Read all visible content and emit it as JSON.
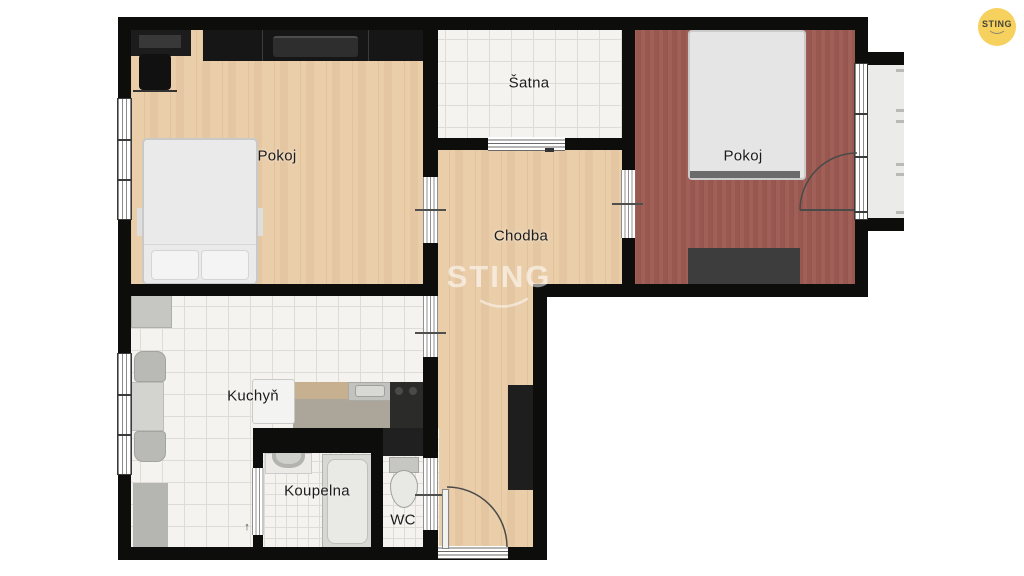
{
  "plan": {
    "rooms": {
      "pokoj1": {
        "label": "Pokoj"
      },
      "satna": {
        "label": "Šatna"
      },
      "chodba": {
        "label": "Chodba"
      },
      "pokoj2": {
        "label": "Pokoj"
      },
      "kuchyn": {
        "label": "Kuchyň"
      },
      "koupelna": {
        "label": "Koupelna"
      },
      "wc": {
        "label": "WC"
      }
    },
    "door_arrow": "↑"
  },
  "watermark": {
    "text": "STING"
  },
  "logo": {
    "text": "STING"
  },
  "colors": {
    "wood": "#e9cba5",
    "red_floor": "#9d5a52",
    "wall": "#0d0d0c",
    "tile": "#f5f3ef",
    "tile_line": "#dfdcd6",
    "balcony": "#ebebe9",
    "logo_yellow": "#f6d15e",
    "counter_wood": "#c7b090",
    "counter_front": "#aba59a",
    "furniture_dark": "#1a1a1a"
  }
}
